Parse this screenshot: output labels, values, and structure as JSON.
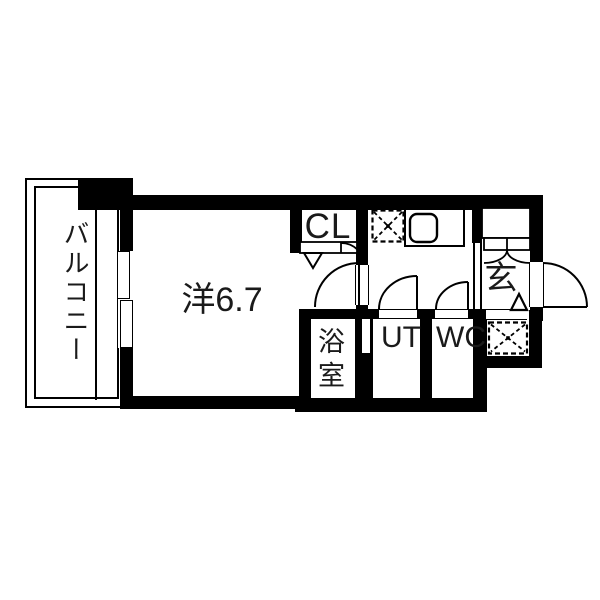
{
  "floorplan": {
    "type": "japanese-apartment-floor-plan",
    "rooms": {
      "balcony": {
        "label": "バルコニー"
      },
      "main_room": {
        "label": "洋6.7"
      },
      "closet": {
        "label": "CL"
      },
      "entrance": {
        "label": "玄"
      },
      "bathroom": {
        "label": "浴室"
      },
      "utility": {
        "label": "UT"
      },
      "toilet": {
        "label": "WC"
      }
    },
    "colors": {
      "wall": "#000000",
      "floor": "#ffffff",
      "line": "#000000",
      "background": "#ffffff"
    },
    "symbols": {
      "x_dashed_box": "appliance-space",
      "quarter_arc": "door-swing",
      "rounded_square": "kitchen-sink",
      "double_line_rect": "sliding-window",
      "v_triangle": "folding-door-mark",
      "small_triangle": "entrance-step-mark"
    }
  }
}
